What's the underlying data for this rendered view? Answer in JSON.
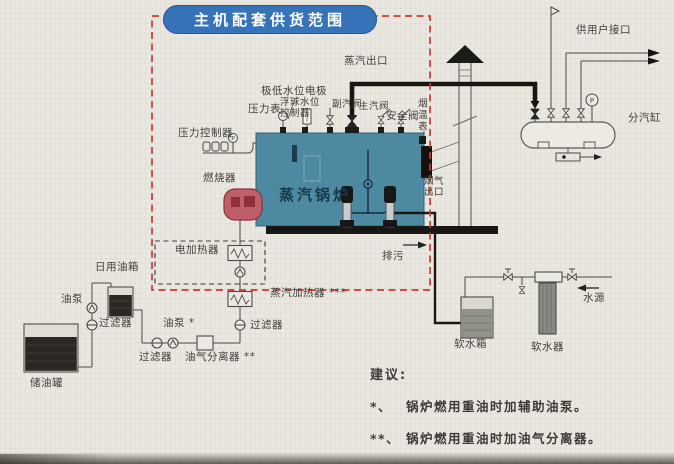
{
  "title": "主机配套供货范围",
  "boiler": {
    "name": "蒸汽锅炉",
    "steam_outlet": "蒸汽出口",
    "low_water_electrode": "极低水位电极",
    "pressure_gauge": "压力表",
    "float_level_controller": "浮球水位\n控制器",
    "aux_steam_valve": "副汽阀",
    "main_steam_valve": "主汽阀",
    "safety_valve": "安全阀",
    "flue_temp_gauge": "烟温表",
    "flue_gas_outlet": "烟气\n出口",
    "pressure_controller": "压力控制器",
    "burner": "燃烧器",
    "blowdown": "排污"
  },
  "steam_header": {
    "label": "分汽缸",
    "user_interface": "供用户接口",
    "gauge_letter": "P"
  },
  "water_system": {
    "soft_water_tank": "软水箱",
    "water_softener": "软水器",
    "water_source": "水源"
  },
  "oil_system": {
    "daily_tank": "日用油箱",
    "oil_pump": "油泵",
    "filter_1": "过滤器",
    "storage_tank": "储油罐",
    "filter_2": "过滤器",
    "oil_pump_aux": "油泵 *",
    "separator": "油气分离器 **",
    "filter_3": "过滤器",
    "steam_heater": "蒸汽加热器 ***",
    "electric_heater": "电加热器"
  },
  "notes": {
    "heading": "建议:",
    "items": [
      {
        "marker": "*、",
        "text": "锅炉燃用重油时加辅助油泵。"
      },
      {
        "marker": "**、",
        "text": "锅炉燃用重油时加油气分离器。"
      },
      {
        "marker": "***、",
        "text": "锅炉燃用重油时加蒸汽加热器。"
      }
    ]
  },
  "colors": {
    "title_bg": "#3673b8",
    "scope_dash": "#c93b33",
    "boiler_body": "#4d8aa2",
    "burner_body": "#c05f6a",
    "page_bg": "#eae7e0"
  }
}
